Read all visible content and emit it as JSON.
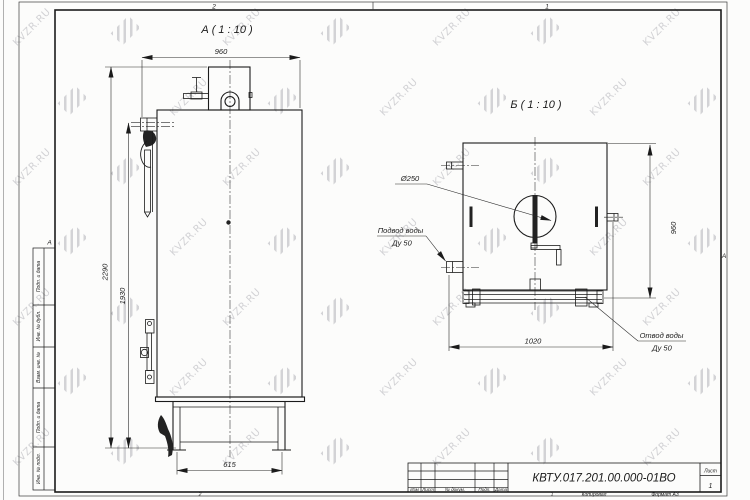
{
  "watermark": {
    "text": "KVZR.RU"
  },
  "frame": {
    "zone_top_left": "2",
    "zone_top_right": "1",
    "zone_left": "А",
    "zone_right": "А",
    "zone_bottom_left": "2",
    "zone_bottom_right": "1",
    "copied_by_label": "Копировал",
    "format_label": "Формат А3"
  },
  "side_strip": {
    "cells": [
      "Подп. и дата",
      "Инв. № дубл.",
      "Взам. инв. №",
      "Подп. и дата",
      "Инв. № подл."
    ]
  },
  "title_block": {
    "doc_number": "КВТУ.017.201.00.000-01ВО",
    "col_izm": "Изм",
    "col_list": "Лист",
    "col_doc": "№ докум.",
    "col_sign": "Подп.",
    "col_date": "Дата",
    "sheet_label": "Лист",
    "sheet_number": "1"
  },
  "view_a": {
    "title": "А ( 1 : 10 )",
    "dim_width": "960",
    "dim_height_overall": "2290",
    "dim_height_body": "1930",
    "dim_base_width": "615"
  },
  "view_b": {
    "title": "Б ( 1 : 10 )",
    "dim_height": "960",
    "dim_width": "1020",
    "dim_diameter": "Ø250",
    "inlet_label_1": "Подвод воды",
    "inlet_label_2": "Ду 50",
    "outlet_label_1": "Отвод воды",
    "outlet_label_2": "Ду 50"
  }
}
